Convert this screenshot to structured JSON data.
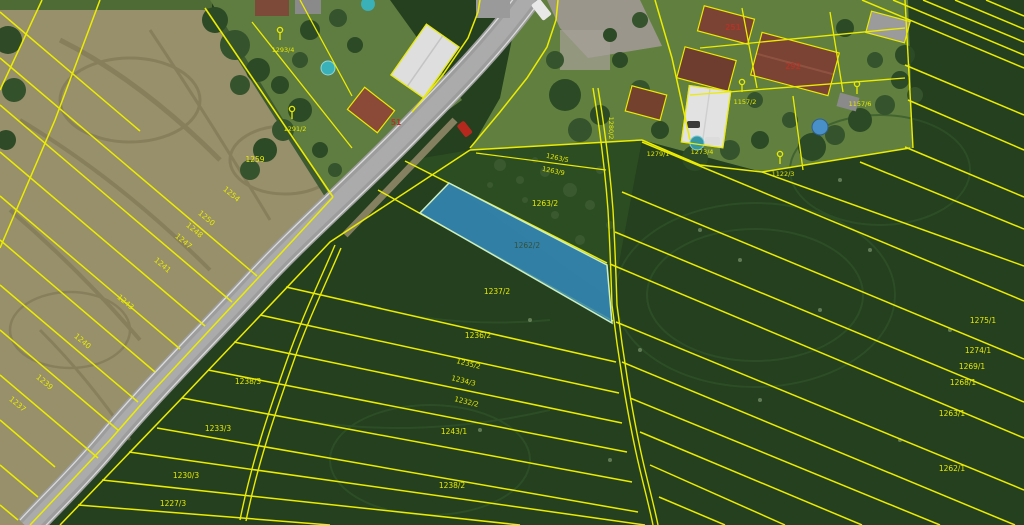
{
  "map": {
    "type": "cadastral-aerial-viewer",
    "colors": {
      "cadastral_line": "#ecec00",
      "parcel_label": "#e8ea00",
      "house_number": "#b03528",
      "selected_fill": "#3387b8",
      "selected_outline": "#cdeec2"
    },
    "selected_parcel": {
      "number": "1262/2",
      "label_x": 527,
      "label_y": 248,
      "label_color": "#33523c"
    },
    "parcel_labels": [
      {
        "t": "1259",
        "x": 255,
        "y": 162,
        "r": 0,
        "s": 7.5
      },
      {
        "t": "1254",
        "x": 230,
        "y": 196,
        "r": 40,
        "s": 7.5
      },
      {
        "t": "1250",
        "x": 205,
        "y": 220,
        "r": 40,
        "s": 7.5
      },
      {
        "t": "1248",
        "x": 193,
        "y": 232,
        "r": 40,
        "s": 7.5
      },
      {
        "t": "1247",
        "x": 182,
        "y": 243,
        "r": 40,
        "s": 7.5
      },
      {
        "t": "1241",
        "x": 161,
        "y": 267,
        "r": 40,
        "s": 7.5
      },
      {
        "t": "1243",
        "x": 124,
        "y": 304,
        "r": 40,
        "s": 7.5
      },
      {
        "t": "1240",
        "x": 81,
        "y": 343,
        "r": 40,
        "s": 7.5
      },
      {
        "t": "1239",
        "x": 43,
        "y": 384,
        "r": 40,
        "s": 7.5
      },
      {
        "t": "1237",
        "x": 16,
        "y": 406,
        "r": 40,
        "s": 7.5
      },
      {
        "t": "1238/3",
        "x": 248,
        "y": 384,
        "r": 0,
        "s": 7.5
      },
      {
        "t": "1233/3",
        "x": 218,
        "y": 431,
        "r": 0,
        "s": 7.5
      },
      {
        "t": "1230/3",
        "x": 186,
        "y": 478,
        "r": 0,
        "s": 7.5
      },
      {
        "t": "1227/3",
        "x": 173,
        "y": 506,
        "r": 0,
        "s": 7.5
      },
      {
        "t": "1263/2",
        "x": 545,
        "y": 206,
        "r": 0,
        "s": 7.5
      },
      {
        "t": "1263/5",
        "x": 557,
        "y": 160,
        "r": 12,
        "s": 6.5
      },
      {
        "t": "1263/9",
        "x": 553,
        "y": 173,
        "r": 12,
        "s": 6.5
      },
      {
        "t": "1237/2",
        "x": 497,
        "y": 294,
        "r": 0,
        "s": 7.5
      },
      {
        "t": "1236/2",
        "x": 478,
        "y": 338,
        "r": 0,
        "s": 7.5
      },
      {
        "t": "1235/2",
        "x": 468,
        "y": 366,
        "r": 14,
        "s": 7
      },
      {
        "t": "1234/3",
        "x": 463,
        "y": 383,
        "r": 14,
        "s": 7
      },
      {
        "t": "1232/2",
        "x": 466,
        "y": 404,
        "r": 14,
        "s": 7
      },
      {
        "t": "1243/1",
        "x": 454,
        "y": 434,
        "r": 0,
        "s": 7.5
      },
      {
        "t": "1238/2",
        "x": 452,
        "y": 488,
        "r": 0,
        "s": 7.5
      },
      {
        "t": "1280/2",
        "x": 609,
        "y": 128,
        "r": 90,
        "s": 6.5
      },
      {
        "t": "1279/1",
        "x": 658,
        "y": 156,
        "r": 0,
        "s": 6.5
      },
      {
        "t": "1273/4",
        "x": 702,
        "y": 154,
        "r": 0,
        "s": 6.5
      },
      {
        "t": "1275/1",
        "x": 983,
        "y": 323,
        "r": 0,
        "s": 7.5
      },
      {
        "t": "1274/1",
        "x": 978,
        "y": 353,
        "r": 0,
        "s": 7.5
      },
      {
        "t": "1269/1",
        "x": 972,
        "y": 369,
        "r": 0,
        "s": 7.5
      },
      {
        "t": "1268/1",
        "x": 963,
        "y": 385,
        "r": 0,
        "s": 7.5
      },
      {
        "t": "1263/1",
        "x": 952,
        "y": 416,
        "r": 0,
        "s": 7.5
      },
      {
        "t": "1262/1",
        "x": 952,
        "y": 471,
        "r": 0,
        "s": 7.5
      }
    ],
    "land_use_markers": [
      {
        "label": "1293/4",
        "x": 280,
        "y": 38
      },
      {
        "label": "1291/2",
        "x": 292,
        "y": 117
      },
      {
        "label": "1157/2",
        "x": 742,
        "y": 90
      },
      {
        "label": "1157/6",
        "x": 857,
        "y": 92
      },
      {
        "label": "1122/3",
        "x": 780,
        "y": 162
      }
    ],
    "house_numbers": [
      {
        "text": "251",
        "x": 733,
        "y": 30
      },
      {
        "text": "292",
        "x": 793,
        "y": 69
      },
      {
        "text": "51",
        "x": 396,
        "y": 125
      }
    ]
  }
}
